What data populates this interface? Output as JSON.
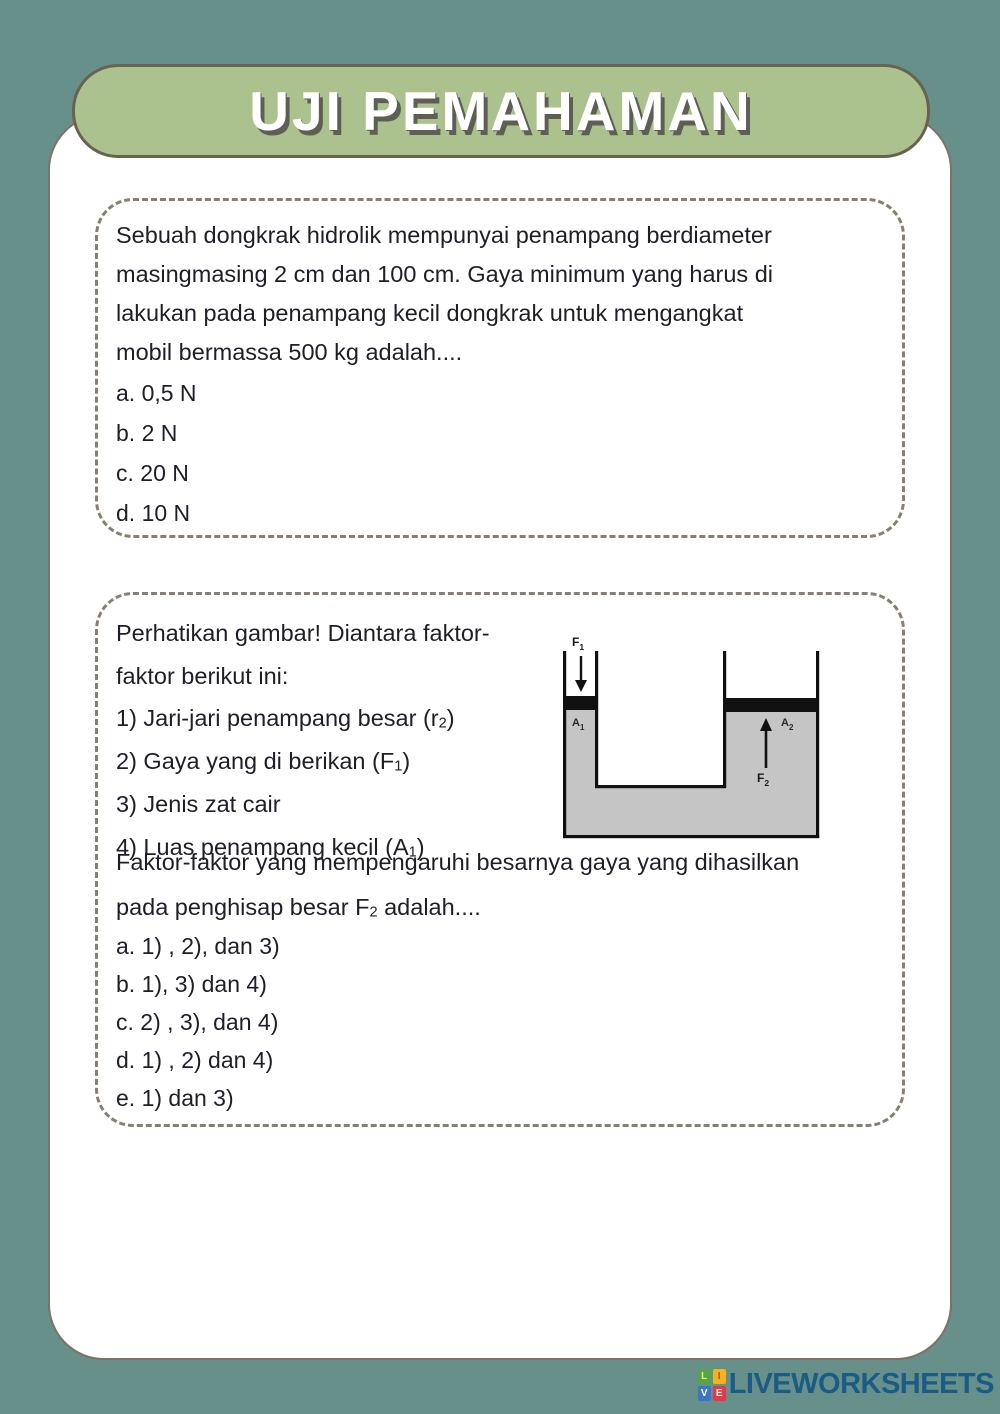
{
  "header": {
    "title": "UJI PEMAHAMAN"
  },
  "question1": {
    "lines": [
      "Sebuah dongkrak hidrolik mempunyai penampang berdiameter",
      "masingmasing 2 cm dan 100 cm. Gaya minimum yang harus di",
      "lakukan pada penampang kecil dongkrak untuk mengangkat",
      "mobil bermassa 500 kg adalah...."
    ],
    "options": [
      "a. 0,5 N",
      "b. 2 N",
      "c. 20 N",
      "d. 10 N"
    ]
  },
  "question2": {
    "intro": [
      {
        "pre": "Perhatikan gambar! Diantara faktor-",
        "sub": "",
        "post": ""
      },
      {
        "pre": "faktor berikut ini:",
        "sub": "",
        "post": ""
      },
      {
        "pre": "1) Jari-jari penampang besar (r",
        "sub": "2",
        "post": ")"
      },
      {
        "pre": "2) Gaya yang di berikan (F",
        "sub": "1",
        "post": ")"
      },
      {
        "pre": "3) Jenis zat cair",
        "sub": "",
        "post": ""
      },
      {
        "pre": "4) Luas penampang kecil (A",
        "sub": "1",
        "post": ")"
      }
    ],
    "stem": [
      {
        "pre": "Faktor-faktor yang mempengaruhi besarnya gaya yang dihasilkan",
        "sub": "",
        "post": ""
      },
      {
        "pre": "pada penghisap besar F",
        "sub": "2",
        "post": " adalah...."
      }
    ],
    "options": [
      "a. 1) , 2), dan 3)",
      "b. 1), 3) dan 4)",
      "c. 2) , 3), dan 4)",
      "d. 1) , 2) dan 4)",
      "e. 1) dan 3)"
    ],
    "diagram": {
      "labels": {
        "f1": {
          "main": "F",
          "sub": "1"
        },
        "a1": {
          "main": "A",
          "sub": "1"
        },
        "a2": {
          "main": "A",
          "sub": "2"
        },
        "f2": {
          "main": "F",
          "sub": "2"
        }
      },
      "liquid_color": "#C5C5C5",
      "line_color": "#111111"
    }
  },
  "footer": {
    "brand": "LIVEWORKSHEETS",
    "squares": [
      {
        "letter": "L",
        "bg": "#55A546",
        "fg": "#F5E663"
      },
      {
        "letter": "I",
        "bg": "#F2B51E",
        "fg": "#D9363A"
      },
      {
        "letter": "V",
        "bg": "#3A76C4",
        "fg": "#FFFFFF"
      },
      {
        "letter": "E",
        "bg": "#E5384A",
        "fg": "#FFFFFF"
      }
    ]
  },
  "colors": {
    "page_bg": "#67908A",
    "banner_bg": "#ABC28E",
    "banner_border": "#686253",
    "card_bg": "#FFFFFF",
    "card_border": "#7B7365",
    "dashed_border": "#87806F",
    "body_text": "#1E1E28",
    "title_text": "#FFFFFF",
    "title_shadow": "#5E5E54",
    "brand_text": "#1B5C86"
  }
}
